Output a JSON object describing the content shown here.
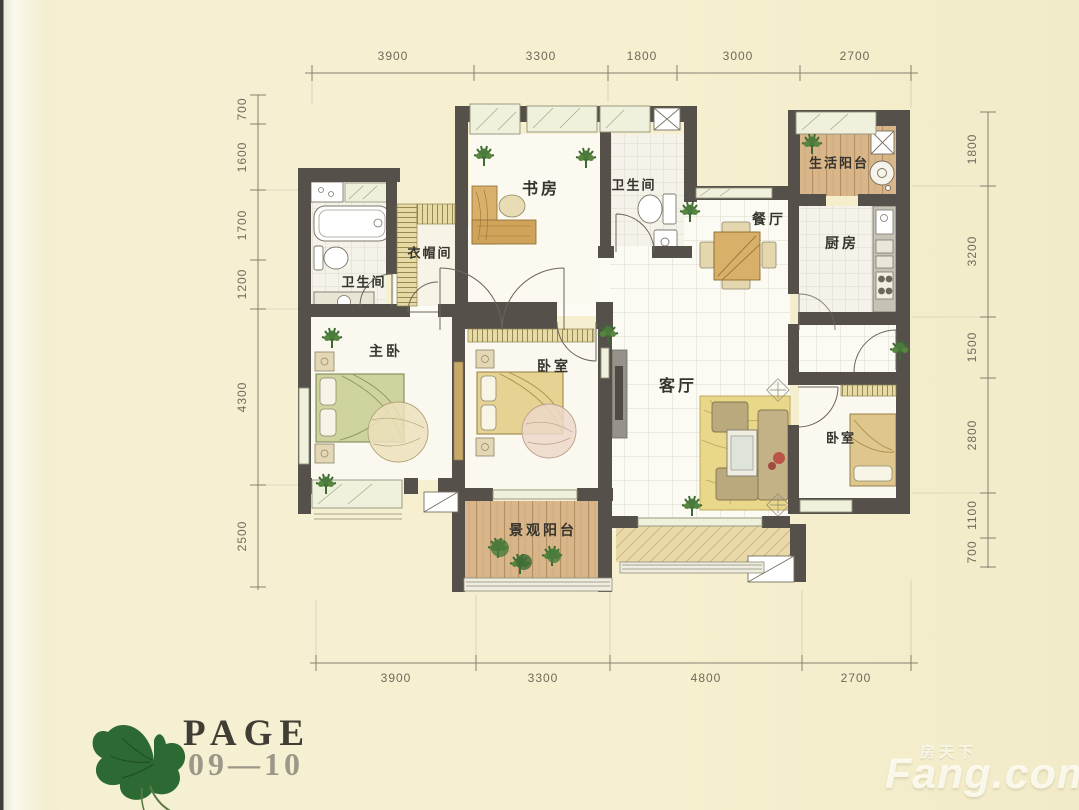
{
  "document": {
    "type": "apartment floor plan",
    "footer": {
      "page_label": "PAGE",
      "page_range": "09—10"
    },
    "watermark": {
      "cn": "房天下",
      "en": "Fang.com"
    }
  },
  "rooms": [
    {
      "id": "study",
      "label": "书房"
    },
    {
      "id": "bath-top",
      "label": "卫生间"
    },
    {
      "id": "service-balcony",
      "label": "生活阳台"
    },
    {
      "id": "dining",
      "label": "餐厅"
    },
    {
      "id": "kitchen",
      "label": "厨房"
    },
    {
      "id": "cloakroom",
      "label": "衣帽间"
    },
    {
      "id": "bath-left",
      "label": "卫生间"
    },
    {
      "id": "master-bedroom",
      "label": "主卧"
    },
    {
      "id": "bedroom-middle",
      "label": "卧室"
    },
    {
      "id": "living-room",
      "label": "客厅"
    },
    {
      "id": "bedroom-right",
      "label": "卧室"
    },
    {
      "id": "view-balcony",
      "label": "景观阳台"
    }
  ],
  "dimensions": {
    "top": [
      "3900",
      "3300",
      "1800",
      "3000",
      "2700"
    ],
    "bottom": [
      "3900",
      "3300",
      "4800",
      "2700"
    ],
    "left": [
      "700",
      "1600",
      "1700",
      "1200",
      "4300",
      "2500"
    ],
    "right": [
      "1800",
      "3200",
      "1500",
      "2800",
      "1100",
      "700"
    ]
  },
  "colors": {
    "paper": "#f6f0d0",
    "wall": "#55514a",
    "wood": "#d8b68a",
    "leaf": "#2d6a33",
    "dimension_text": "#6f6a5c"
  }
}
